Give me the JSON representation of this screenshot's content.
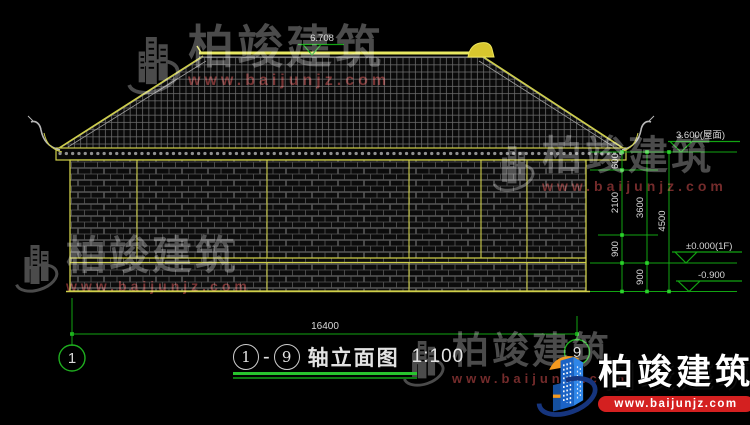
{
  "title_block": {
    "axis_start": "1",
    "axis_end": "9",
    "dash": "-",
    "name": "轴立面图",
    "scale": "1:100"
  },
  "levels": {
    "ridge": "6.708",
    "eave": "3.600(屋面)",
    "floor": "±0.000(1F)",
    "ground": "-0.900"
  },
  "dims": {
    "eave_depth": "600",
    "upper": "2100",
    "sill": "900",
    "plinth": "900",
    "wall": "3600",
    "overall": "4500",
    "total_width": "16400"
  },
  "axis_bubbles": {
    "left": "1",
    "right": "9"
  },
  "watermark": {
    "brand": "柏竣建筑",
    "url": "www.baijunjz.com"
  },
  "logo": {
    "brand": "柏竣建筑",
    "url": "www.baijunjz.com"
  },
  "colors": {
    "background": "#000000",
    "cad_green": "#12a412",
    "tick_green": "#2bd32b",
    "cad_yellow": "#cfcf4a",
    "ridge_yellow": "#e8e862",
    "dim_text": "#d9d9d9",
    "watermark_grey": "#4f4f4f",
    "watermark_url_red": "#7a2d2d",
    "logo_blue": "#1e6fd0",
    "logo_navy": "#16357e",
    "logo_orange": "#f59a1f",
    "url_bar_red": "#d42020"
  }
}
